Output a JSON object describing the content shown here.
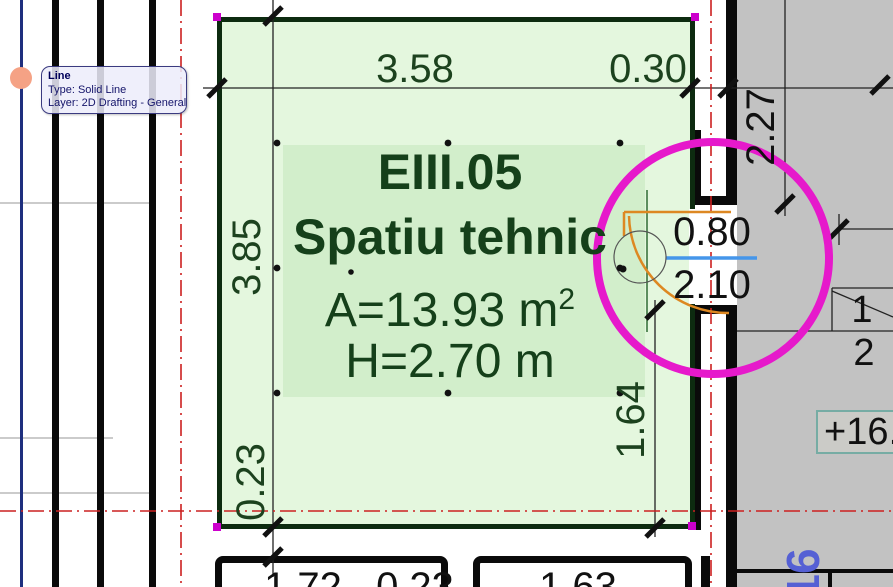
{
  "tooltip": {
    "title": "Line",
    "type_line": "Type: Solid Line",
    "layer_line": "Layer: 2D Drafting - General"
  },
  "zone": {
    "code": "EIII.05",
    "name": "Spatiu tehnic",
    "area_label": "A=13.93 m",
    "area_sup": "2",
    "height_label": "H=2.70 m"
  },
  "dimensions": {
    "top_width": "3.58",
    "top_wall": "0.30",
    "left_height": "3.85",
    "left_wall": "0.23",
    "right_height": "1.64",
    "right_offset": "2.27",
    "door_width": "0.80",
    "door_height": "2.10",
    "bottom_left_width": "1.72",
    "bottom_left_wall": "0.23",
    "bottom_right_width": "1.63"
  },
  "stairs": {
    "tread_1": "1",
    "tread_2": "2"
  },
  "annotations": {
    "elevation": "+16.",
    "grid_label": "16"
  },
  "colors": {
    "selection_magenta": "#e619cb",
    "handle_magenta": "#cc00cc",
    "zone_fill": "#e4f7de",
    "zone_stamp_fill": "#d2eecb",
    "zone_border": "#0d2b10",
    "zone_text": "#15401a",
    "axis_red": "#cc2020",
    "door_orange": "#dd8822",
    "door_sill_blue": "#4596ea",
    "gray_area": "#c2c2c2",
    "elevation_border": "#76aca4",
    "grid_text_blue": "#5560d4",
    "snap_dot_salmon": "#f5a285",
    "guide_navy": "#1e2f7e"
  }
}
